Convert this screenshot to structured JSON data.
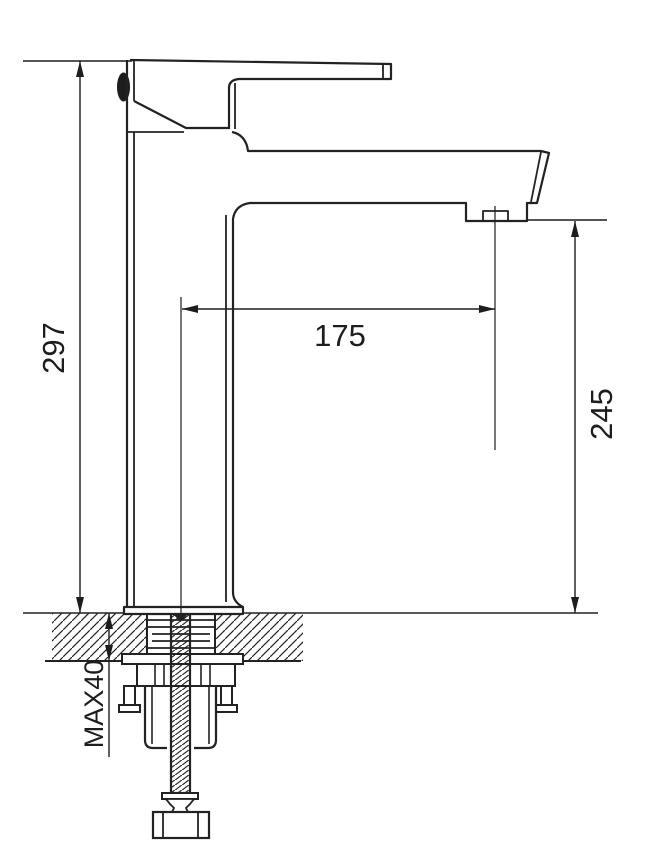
{
  "drawing": {
    "type": "technical-drawing",
    "subject": "single-lever basin mixer faucet, side elevation with mounting cross-section",
    "background_color": "#ffffff",
    "line_color": "#222222",
    "dimensions": {
      "overall_height_label": "297",
      "spout_reach_label": "175",
      "outlet_height_label": "245",
      "max_mount_thickness_label": "MAX40"
    }
  }
}
